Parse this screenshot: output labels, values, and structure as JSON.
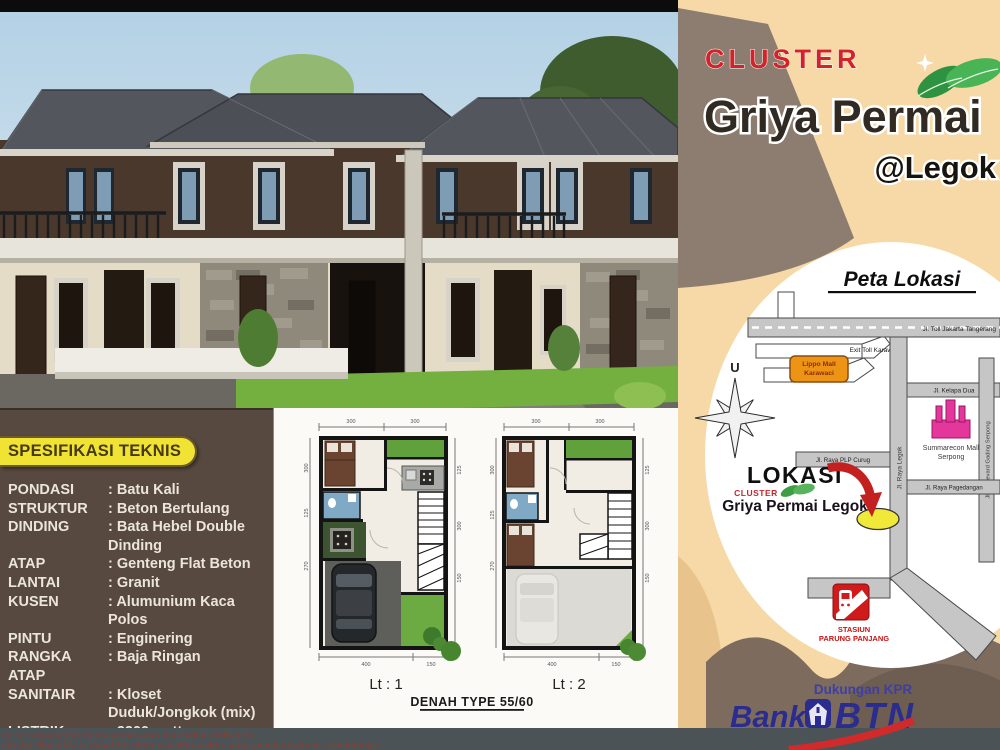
{
  "header": {
    "cluster": "CLUSTER",
    "title": "Griya Permai",
    "location_tag": "@Legok"
  },
  "map": {
    "title": "Peta Lokasi",
    "compass": "U",
    "toll_road": "Jl. Toll Jakarta Tangerang",
    "toll_exit": "Exit Toll Karawaci",
    "lippo_mall_line1": "Lippo Mall",
    "lippo_mall_line2": "Karawaci",
    "jl_raya_legok": "Jl. Raya Legok",
    "jl_kelapa_dua": "Jl. Kelapa Dua",
    "jl_boulevard": "Jl. Boulevard Gading Serpong",
    "jl_plp_curug": "Jl. Raya PLP Curug",
    "jl_pagedangan": "Jl. Raya Pagedangan",
    "summarecon_line1": "Summarecon Mall",
    "summarecon_line2": "Serpong",
    "lokasi": "LOKASI",
    "lokasi_cluster": "CLUSTER",
    "lokasi_name": "Griya Permai Legok",
    "station_line1": "STASIUN",
    "station_line2": "PARUNG PANJANG"
  },
  "brand": {
    "support": "Dukungan KPR",
    "bank": "Bank",
    "btn": "BTN"
  },
  "specs": {
    "heading": "SPESIFIKASI TEKNIS",
    "rows": [
      {
        "label": "PONDASI",
        "value": ": Batu Kali"
      },
      {
        "label": "STRUKTUR",
        "value": ": Beton Bertulang"
      },
      {
        "label": "DINDING",
        "value": ": Bata Hebel Double Dinding"
      },
      {
        "label": "ATAP",
        "value": ": Genteng Flat Beton"
      },
      {
        "label": "LANTAI",
        "value": ": Granit"
      },
      {
        "label": "KUSEN",
        "value": ": Alumunium Kaca Polos"
      },
      {
        "label": "PINTU",
        "value": ": Enginering"
      },
      {
        "label": "RANGKA ATAP",
        "value": ": Baja Ringan"
      },
      {
        "label": "SANITAIR",
        "value": ": Kloset Duduk/Jongkok (mix)"
      },
      {
        "label": "LISTRIK",
        "value": ": 2200 watt"
      },
      {
        "label": "AIR BERSIH",
        "value": ": Pompa Listrik"
      }
    ]
  },
  "plans": {
    "floor1": "Lt : 1",
    "floor2": "Lt : 2",
    "type": "DENAH TYPE 55/60",
    "p1_dims_top": [
      "300",
      "300"
    ],
    "p1_dims_bottom": [
      "400",
      "150"
    ],
    "p1_dims_left": [
      "300",
      "125",
      "270"
    ],
    "p1_dims_right": [
      "125",
      "300",
      "150"
    ],
    "p2_dims_top": [
      "300",
      "300"
    ],
    "p2_dims_bottom": [
      "400",
      "150"
    ],
    "p2_dims_left": [
      "300",
      "125",
      "270"
    ],
    "p2_dims_right": [
      "125",
      "300",
      "150"
    ]
  },
  "disclaimer": {
    "line1": "ur ini sebagai informasi pemasaran dan bukan dokumen.",
    "line2": "ain dan Spesifikasi dapat berubah sewaktu-waktu tanpa pemberitahuan sebelumnya."
  },
  "colors": {
    "cream": "#f6d9a6",
    "accent_red": "#d22328",
    "title_brown": "#302a22",
    "panel_brown": "#57493f",
    "banner_yellow": "#f0e334",
    "btn_blue": "#2b2d8e",
    "map_road_gray": "#c6c6c6",
    "marker_yellow": "#f1e93a",
    "strip_gray": "#4c5357"
  }
}
